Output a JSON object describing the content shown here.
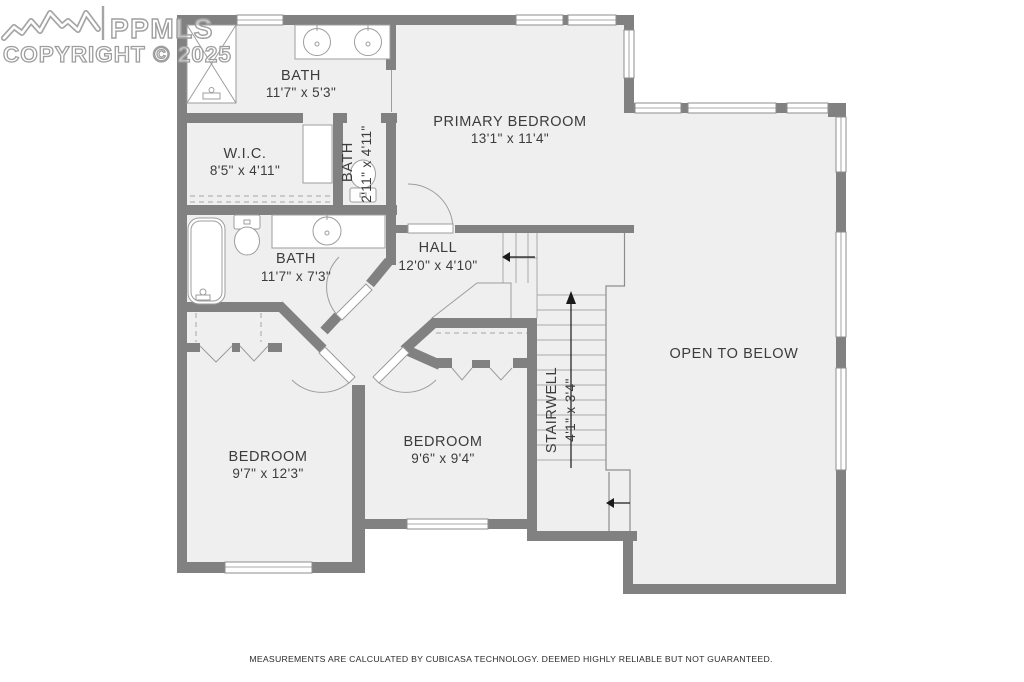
{
  "watermark": {
    "brand": "PPMLS",
    "copyright": "COPYRIGHT © 2025"
  },
  "footer": {
    "disclaimer": "MEASUREMENTS ARE CALCULATED BY CUBICASA TECHNOLOGY. DEEMED HIGHLY RELIABLE BUT NOT GUARANTEED."
  },
  "rooms": {
    "bath_top": {
      "name": "BATH",
      "dims": "11'7\" x 5'3\""
    },
    "wic": {
      "name": "W.I.C.",
      "dims": "8'5\" x 4'11\""
    },
    "bath_small": {
      "name": "BATH",
      "dims": "2'11\" x 4'11\""
    },
    "primary_bedroom": {
      "name": "PRIMARY BEDROOM",
      "dims": "13'1\" x 11'4\""
    },
    "hall": {
      "name": "HALL",
      "dims": "12'0\" x 4'10\""
    },
    "bath_main": {
      "name": "BATH",
      "dims": "11'7\" x 7'3\""
    },
    "stairwell": {
      "name": "STAIRWELL",
      "dims": "4'1\" x 3'4\""
    },
    "open_to_below": {
      "name": "OPEN TO BELOW"
    },
    "bedroom_left": {
      "name": "BEDROOM",
      "dims": "9'7\" x 12'3\""
    },
    "bedroom_right": {
      "name": "BEDROOM",
      "dims": "9'6\" x 9'4\""
    }
  },
  "colors": {
    "wall": "#818181",
    "floor": "#efefef",
    "fixture_line": "#9d9d9d",
    "text": "#3c3c3c"
  }
}
